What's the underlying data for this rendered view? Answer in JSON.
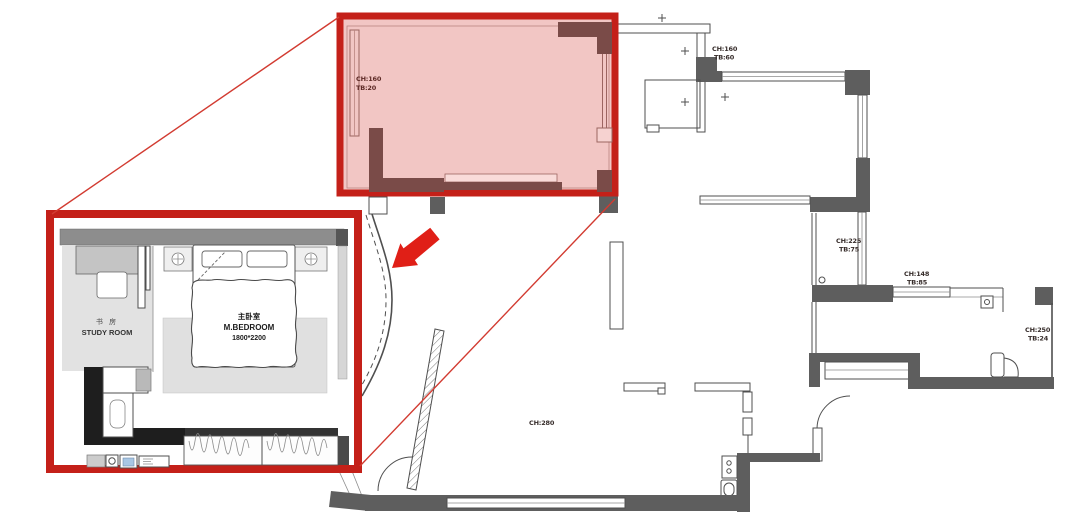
{
  "meta": {
    "type": "architectural-floor-plan-with-highlight-and-detail-inset"
  },
  "inset": {
    "study_room": {
      "name_cn": "书 房",
      "name_en": "STUDY ROOM"
    },
    "master_bedroom": {
      "name_cn": "主卧室",
      "name_en": "M.BEDROOM",
      "bed_size": "1800*2200"
    }
  },
  "annotations": {
    "highlighted_room": {
      "line1": "CH:160",
      "line2": "TB:20"
    },
    "foyer": {
      "line1": "CH:160",
      "line2": "TB:60"
    },
    "corridor": {
      "line1": "CH:225",
      "line2": "TB:75"
    },
    "balcony_top": {
      "line1": "CH:148",
      "line2": "TB:85"
    },
    "balcony_right": {
      "line1": "CH:250",
      "line2": "TB:24"
    },
    "living_room": {
      "line1": "CH:280"
    }
  },
  "colors": {
    "highlight_border": "#c42019",
    "highlight_fill": "#f2c6c4",
    "highlight_wall": "#7a4b48",
    "inset_border": "#c42019",
    "leader_line": "#d23b31",
    "arrow": "#e01f17",
    "wall_dark": "#5e5e5e"
  }
}
